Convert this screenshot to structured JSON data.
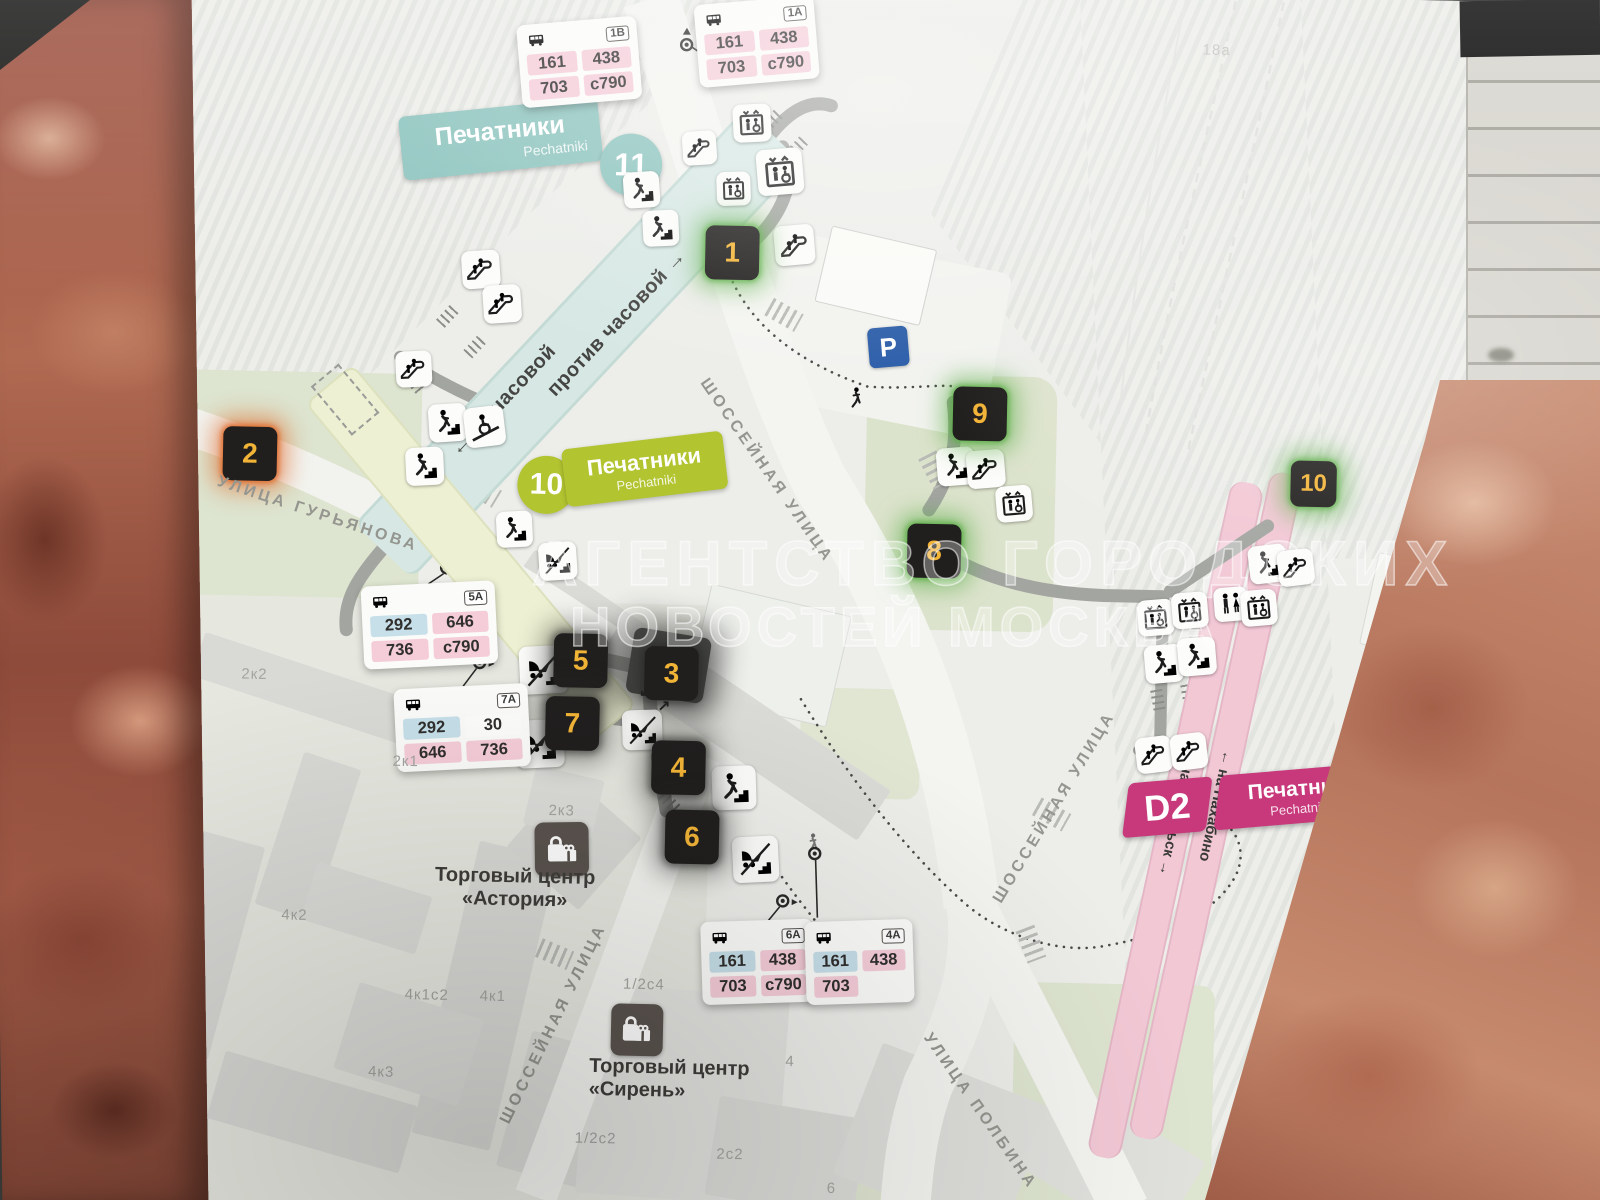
{
  "watermark": {
    "line1": "АГЕНТСТВО ГОРОДСКИХ",
    "line2": "НОВОСТЕЙ МОСКВА"
  },
  "station": {
    "line11": {
      "number": "11",
      "name": "Печатники",
      "name_latin": "Pechatniki",
      "dir_clockwise": "← по часовой",
      "dir_counterclockwise": "против часовой →"
    },
    "line10": {
      "number": "10",
      "name": "Печатники",
      "name_latin": "Pechatniki"
    },
    "d2": {
      "number": "D2",
      "name": "Печатники",
      "name_latin": "Pechatniki",
      "to_north": "← на Нахабино",
      "to_south": "на Подольск →"
    }
  },
  "exits": [
    {
      "number": "1",
      "glow": "green"
    },
    {
      "number": "2",
      "glow": "orange"
    },
    {
      "number": "3",
      "glow": "dark"
    },
    {
      "number": "4",
      "glow": "dark"
    },
    {
      "number": "5",
      "glow": "dark"
    },
    {
      "number": "6",
      "glow": "dark"
    },
    {
      "number": "7",
      "glow": "dark"
    },
    {
      "number": "8",
      "glow": "green"
    },
    {
      "number": "9",
      "glow": "green"
    },
    {
      "number": "10",
      "glow": "green"
    }
  ],
  "bus_stops": [
    {
      "code": "1В",
      "routes": [
        {
          "label": "161",
          "color": "pink"
        },
        {
          "label": "438",
          "color": "pink"
        },
        {
          "label": "703",
          "color": "pink"
        },
        {
          "label": "с790",
          "color": "pink"
        }
      ]
    },
    {
      "code": "1А",
      "routes": [
        {
          "label": "161",
          "color": "pink"
        },
        {
          "label": "438",
          "color": "pink"
        },
        {
          "label": "703",
          "color": "pink"
        },
        {
          "label": "с790",
          "color": "pink"
        }
      ]
    },
    {
      "code": "5А",
      "routes": [
        {
          "label": "292",
          "color": "blue"
        },
        {
          "label": "646",
          "color": "pink"
        },
        {
          "label": "736",
          "color": "pink"
        },
        {
          "label": "с790",
          "color": "pink"
        }
      ]
    },
    {
      "code": "7А",
      "routes": [
        {
          "label": "292",
          "color": "blue"
        },
        {
          "label": "30",
          "color": "white"
        },
        {
          "label": "646",
          "color": "pink"
        },
        {
          "label": "736",
          "color": "pink"
        }
      ]
    },
    {
      "code": "6А",
      "routes": [
        {
          "label": "161",
          "color": "blue"
        },
        {
          "label": "438",
          "color": "pink"
        },
        {
          "label": "703",
          "color": "pink"
        },
        {
          "label": "с790",
          "color": "pink"
        }
      ]
    },
    {
      "code": "4А",
      "routes": [
        {
          "label": "161",
          "color": "blue"
        },
        {
          "label": "438",
          "color": "pink"
        },
        {
          "label": "703",
          "color": "pink"
        }
      ]
    }
  ],
  "streets": [
    "УЛИЦА ГУРЬЯНОВА",
    "ШОССЕЙНАЯ УЛИЦА",
    "ШОССЕЙНАЯ УЛИЦА",
    "УЛИЦА ПОЛБИНА",
    "ШОССЕЙНАЯ УЛИЦА"
  ],
  "buildings": [
    "2к2",
    "2к1",
    "4к2",
    "4к1с2",
    "4к1",
    "4к3",
    "2к3",
    "1/2с4",
    "1/2с2",
    "2с2",
    "6",
    "4",
    "18а"
  ],
  "places": [
    {
      "line1": "Торговый центр",
      "line2": "«Астория»"
    },
    {
      "line1": "Торговый центр",
      "line2": "«Сирень»"
    }
  ],
  "parking_label": "P",
  "exit3_arrows": {
    "down": "↙",
    "up": "↗"
  },
  "icons": {
    "bus": "bus-icon",
    "stop_pole": "bus-stop-pole-icon",
    "stairs": "stairs-person-icon",
    "escalator": "escalator-icon",
    "elevator": "elevator-icon",
    "stroller_stairs": "stroller-stairs-icon",
    "wheelchair_ramp": "wheelchair-ramp-icon",
    "toilets": "wc-icon",
    "parking": "parking-icon",
    "shopping": "shopping-bags-icon",
    "pedestrian": "walking-person-icon"
  },
  "palette": {
    "line11": "#8fc5bf",
    "line10": "#b2c430",
    "d2": "#c8397b",
    "exit_bg": "#211f1e",
    "exit_number": "#f2b437",
    "glow_green": "#58ac43",
    "glow_orange": "#df6320",
    "route_pink": "#f5cdd9",
    "route_blue": "#c6dfe9",
    "parking_blue": "#2a5ca8",
    "map_bg": "#edeeea",
    "park_green": "#dde4cf",
    "rail_pink": "#f2c8d5",
    "marble": "#a85a45"
  }
}
